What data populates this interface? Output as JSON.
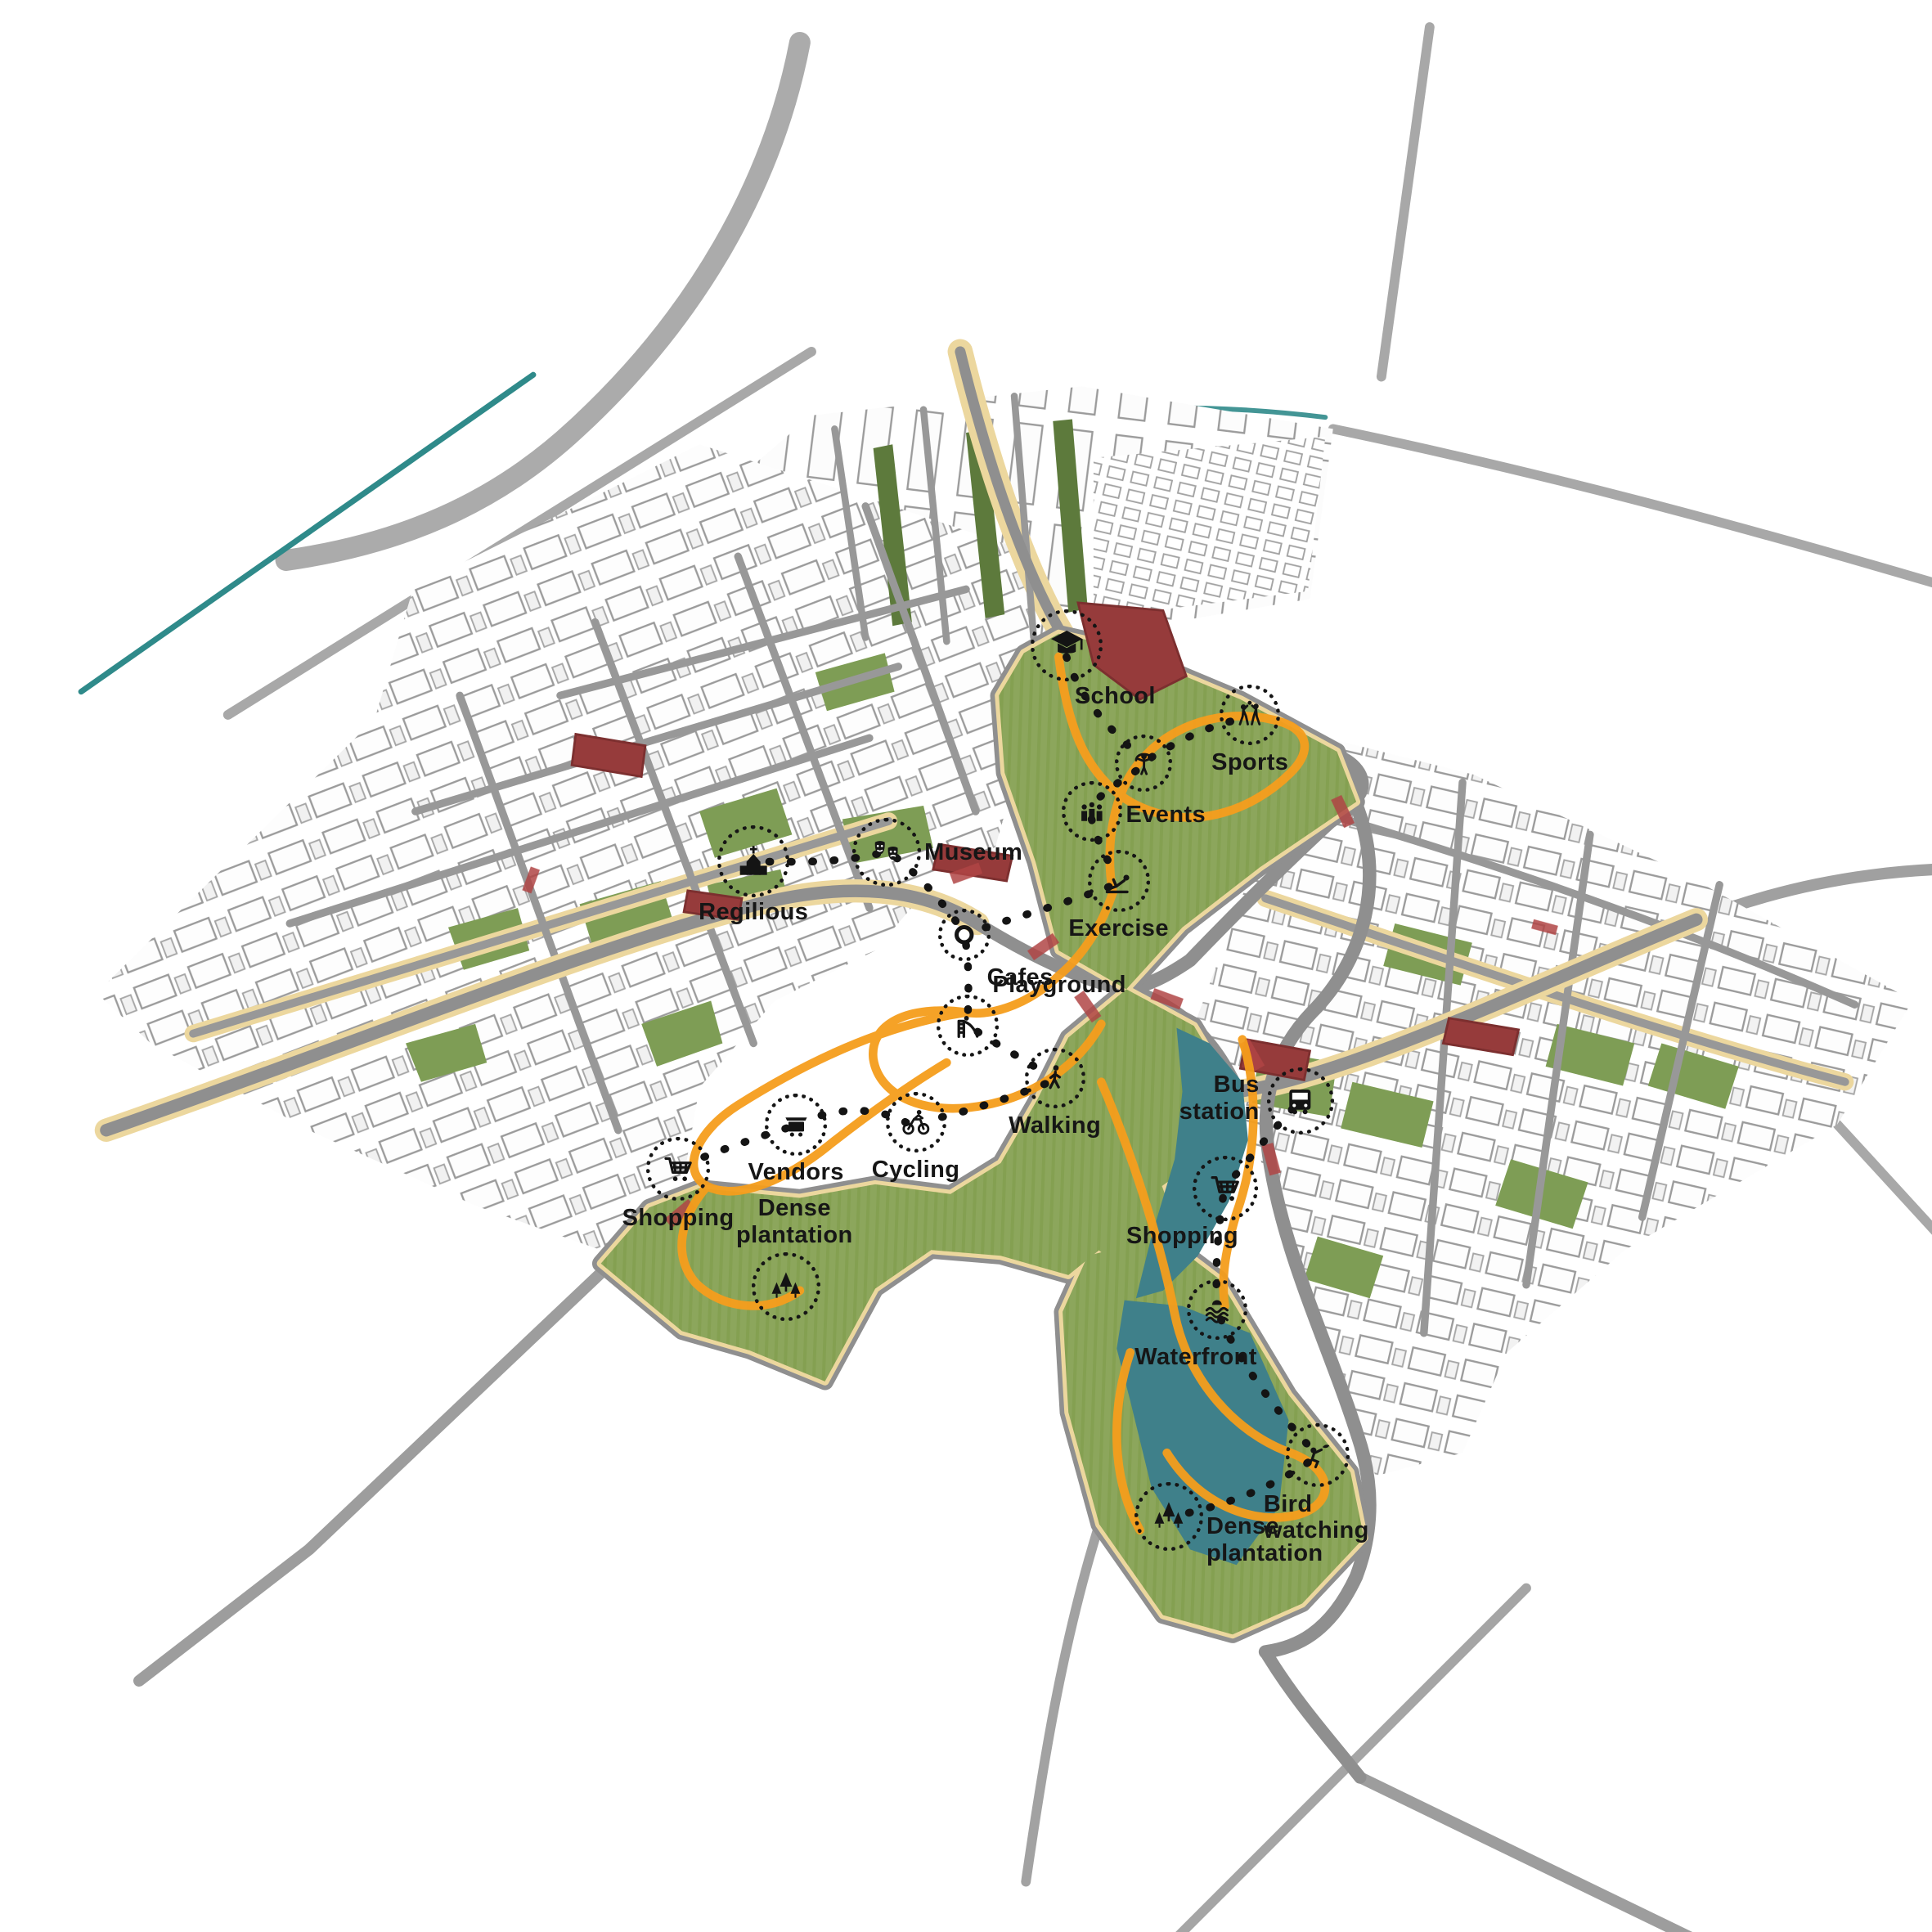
{
  "figure": {
    "kind": "urban masterplan axonometric activity diagram",
    "background": "#ffffff"
  },
  "palette": {
    "park_green": "#8ca65c",
    "park_stripe": "#84a051",
    "water_teal": "#3f808a",
    "road_gray": "#8f8f8f",
    "sidewalk_cream": "#ecd79e",
    "path_orange": "#f59d1c",
    "landmark_red": "#963b3b",
    "city_outline": "#9b9b9b",
    "river_teal": "#2f8a8a",
    "annotation_black": "#141414"
  },
  "annotations": [
    {
      "id": "school",
      "icon": "school",
      "label": "School",
      "x": 55.2,
      "y": 33.4,
      "size": 88,
      "label_dx": 10,
      "label_dy": 46,
      "align": "left"
    },
    {
      "id": "activity-person",
      "icon": "person",
      "label": "",
      "x": 59.2,
      "y": 39.5,
      "size": 70,
      "label_dx": 0,
      "label_dy": 0,
      "align": "center"
    },
    {
      "id": "sports",
      "icon": "sports",
      "label": "Sports",
      "x": 64.7,
      "y": 37.0,
      "size": 74,
      "label_dx": 0,
      "label_dy": 42,
      "align": "center"
    },
    {
      "id": "events",
      "icon": "events",
      "label": "Events",
      "x": 56.5,
      "y": 42.0,
      "size": 74,
      "label_dx": 42,
      "label_dy": -12,
      "align": "left"
    },
    {
      "id": "exercise",
      "icon": "exercise",
      "label": "Exercise",
      "x": 57.9,
      "y": 45.6,
      "size": 76,
      "label_dx": 0,
      "label_dy": 42,
      "align": "center"
    },
    {
      "id": "museum",
      "icon": "museum",
      "label": "Museum",
      "x": 45.9,
      "y": 44.1,
      "size": 84,
      "label_dx": 46,
      "label_dy": -16,
      "align": "left"
    },
    {
      "id": "religious",
      "icon": "religious",
      "label": "Regilious",
      "x": 39.0,
      "y": 44.6,
      "size": 88,
      "label_dx": 0,
      "label_dy": 46,
      "align": "center"
    },
    {
      "id": "cafes",
      "icon": "cafes",
      "label": "Cafes",
      "x": 49.9,
      "y": 48.4,
      "size": 64,
      "label_dx": 28,
      "label_dy": 36,
      "align": "left"
    },
    {
      "id": "playground",
      "icon": "playground",
      "label": "Playground",
      "x": 50.1,
      "y": 53.1,
      "size": 76,
      "label_dx": 30,
      "label_dy": -66,
      "align": "left"
    },
    {
      "id": "walking",
      "icon": "walking",
      "label": "Walking",
      "x": 54.6,
      "y": 55.8,
      "size": 74,
      "label_dx": 0,
      "label_dy": 42,
      "align": "center"
    },
    {
      "id": "cycling",
      "icon": "cycling",
      "label": "Cycling",
      "x": 47.4,
      "y": 58.1,
      "size": 74,
      "label_dx": 0,
      "label_dy": 42,
      "align": "center"
    },
    {
      "id": "vendors",
      "icon": "vendors",
      "label": "Vendors",
      "x": 41.2,
      "y": 58.2,
      "size": 76,
      "label_dx": 0,
      "label_dy": 42,
      "align": "center"
    },
    {
      "id": "shopping-west",
      "icon": "shopping",
      "label": "Shopping",
      "x": 35.1,
      "y": 60.5,
      "size": 78,
      "label_dx": 0,
      "label_dy": 44,
      "align": "center"
    },
    {
      "id": "dense-plantation-west",
      "icon": "trees",
      "label": "Dense\nplantation",
      "x": 40.7,
      "y": 66.6,
      "size": 84,
      "label_dx": 10,
      "label_dy": -112,
      "align": "center"
    },
    {
      "id": "bus-station",
      "icon": "bus",
      "label": "Bus\nstation",
      "x": 67.3,
      "y": 57.0,
      "size": 82,
      "label_dx": -50,
      "label_dy": -36,
      "align": "right"
    },
    {
      "id": "shopping-east",
      "icon": "shopping",
      "label": "Shopping",
      "x": 63.4,
      "y": 61.5,
      "size": 80,
      "label_dx": -52,
      "label_dy": 42,
      "align": "center"
    },
    {
      "id": "waterfront",
      "icon": "waterfront",
      "label": "Waterfront",
      "x": 63.0,
      "y": 67.8,
      "size": 74,
      "label_dx": -26,
      "label_dy": 42,
      "align": "center"
    },
    {
      "id": "bird-watching",
      "icon": "bird",
      "label": "Bird\nwatching",
      "x": 68.2,
      "y": 75.3,
      "size": 78,
      "label_dx": -66,
      "label_dy": 44,
      "align": "left"
    },
    {
      "id": "dense-plantation-south",
      "icon": "trees",
      "label": "Dense\nplantation",
      "x": 60.5,
      "y": 78.5,
      "size": 84,
      "label_dx": 46,
      "label_dy": -4,
      "align": "left"
    }
  ]
}
